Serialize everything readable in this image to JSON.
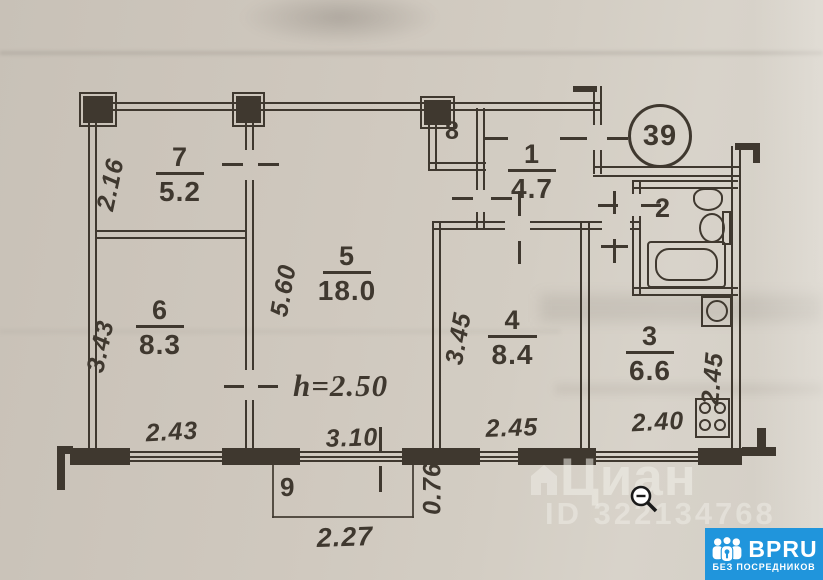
{
  "plan": {
    "apartment_circle": "39",
    "height_note": "h=2.50",
    "rooms": {
      "r1": {
        "num": "1",
        "area": "4.7"
      },
      "r2": {
        "num": "2"
      },
      "r3": {
        "num": "3",
        "area": "6.6"
      },
      "r4": {
        "num": "4",
        "area": "8.4"
      },
      "r5": {
        "num": "5",
        "area": "18.0"
      },
      "r6": {
        "num": "6",
        "area": "8.3"
      },
      "r7": {
        "num": "7",
        "area": "5.2"
      },
      "r8": {
        "num": "8"
      },
      "r9": {
        "num": "9"
      }
    },
    "dims": {
      "r7_left": "2.16",
      "r6_left": "3.43",
      "r6_bottom": "2.43",
      "r5_left": "5.60",
      "r5_bottom": "3.10",
      "r4_left": "3.45",
      "r4_bottom": "2.45",
      "r3_right": "2.45",
      "r3_bottom": "2.40",
      "balcony_bottom": "2.27",
      "balcony_side": "0.76"
    }
  },
  "watermark": {
    "brand": "Циан",
    "listing_id": "ID 322134768"
  },
  "badge": {
    "brand": "BPRU",
    "tagline": "БЕЗ ПОСРЕДНИКОВ",
    "bg_color": "#2095dc"
  },
  "colors": {
    "ink": "#3f382f",
    "paper": "#cfc8be"
  },
  "icons": {
    "cursor": "zoom-out-magnifier-icon",
    "watermark_logo": "cian-house-icon",
    "badge_logo": "people-group-icon"
  }
}
